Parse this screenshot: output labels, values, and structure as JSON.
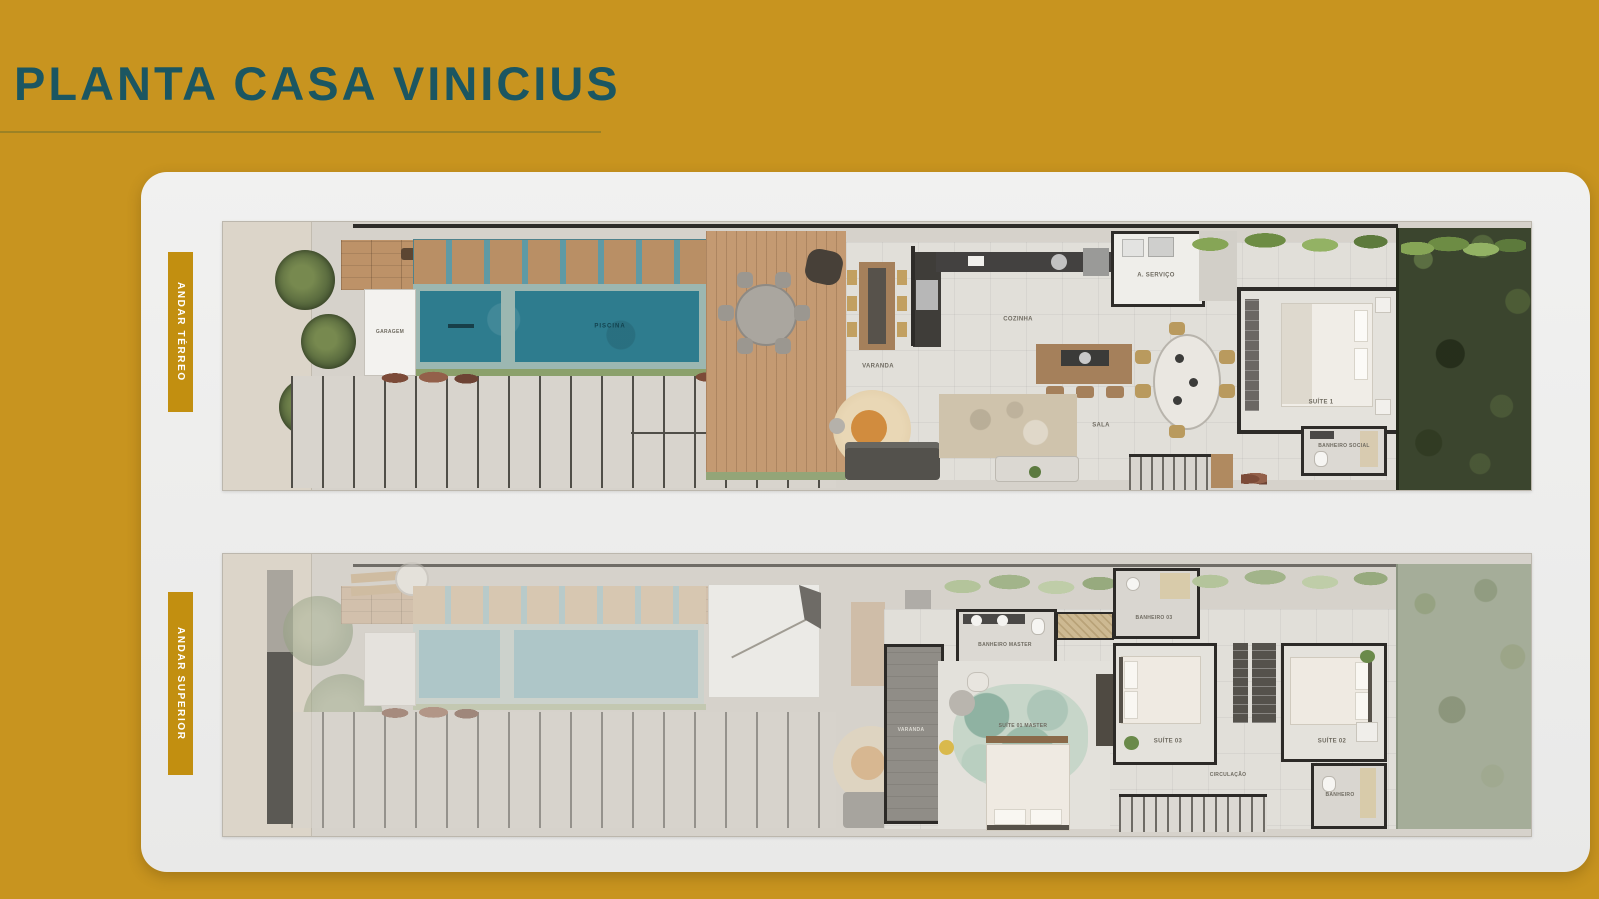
{
  "slide": {
    "title": "PLANTA CASA VINICIUS"
  },
  "colors": {
    "background": "#c8941f",
    "title_teal": "#1b5661",
    "tab_gold": "#c28f10",
    "card": "#ececec",
    "pool_water": "#2e7c8e",
    "pool_water_faded": "#8abcc6",
    "wood_deck": "#c49a72",
    "wall": "#2e2c29",
    "garden_green": "#3b452e"
  },
  "floors": {
    "terreo": {
      "tab_label": "ANDAR TÉRREO",
      "rooms": {
        "garagem": "GARAGEM",
        "piscina": "PISCINA",
        "varanda": "VARANDA",
        "cozinha": "COZINHA",
        "sala": "SALA",
        "servico": "A. SERVIÇO",
        "suite1": "SUÍTE 1",
        "banheiro_social": "BANHEIRO SOCIAL"
      }
    },
    "superior": {
      "tab_label": "ANDAR SUPERIOR",
      "rooms": {
        "varanda": "VARANDA",
        "banheiro_master": "BANHEIRO MASTER",
        "suite_master": "SUÍTE 01 MASTER",
        "banheiro03": "BANHEIRO 03",
        "suite03": "SUÍTE 03",
        "suite02": "SUÍTE 02",
        "circulacao": "CIRCULAÇÃO",
        "banheiro": "BANHEIRO"
      }
    }
  }
}
